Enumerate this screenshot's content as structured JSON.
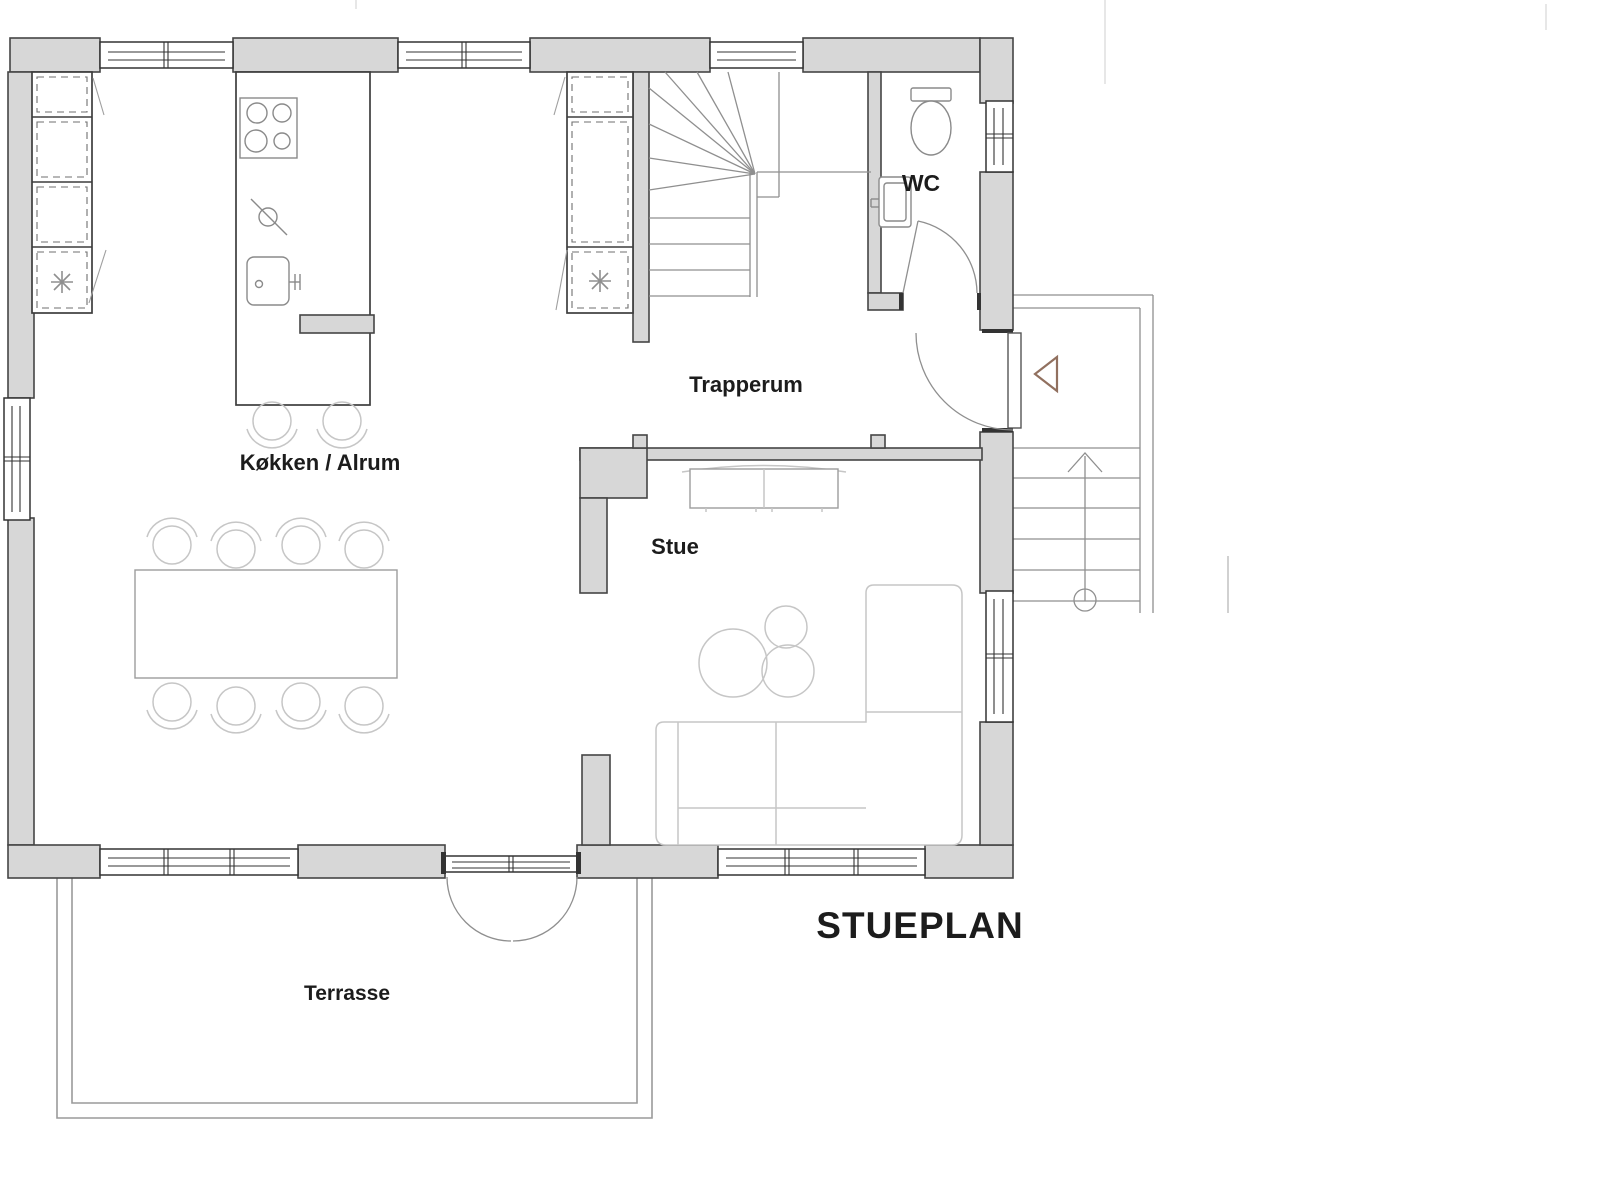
{
  "header": {
    "plan_title": "STUEPLAN"
  },
  "rooms": [
    {
      "key": "kitchen-dining",
      "label": "Køkken / Alrum"
    },
    {
      "key": "stairwell",
      "label": "Trapperum"
    },
    {
      "key": "living-room",
      "label": "Stue"
    },
    {
      "key": "toilet",
      "label": "WC"
    },
    {
      "key": "terrace",
      "label": "Terrasse"
    }
  ],
  "colors": {
    "wall-fill": "#d7d7d7",
    "wall-stroke": "#454545",
    "frame": "#333333",
    "door-line": "#8f8f8f",
    "fixture-line": "#8a8a8a",
    "furniture-line": "#c6c6c6",
    "furniture-dark": "#9c9c9c",
    "text": "#1c1c1c",
    "entry-arrow": "#91705f",
    "artifact": "#e7e7e7"
  }
}
